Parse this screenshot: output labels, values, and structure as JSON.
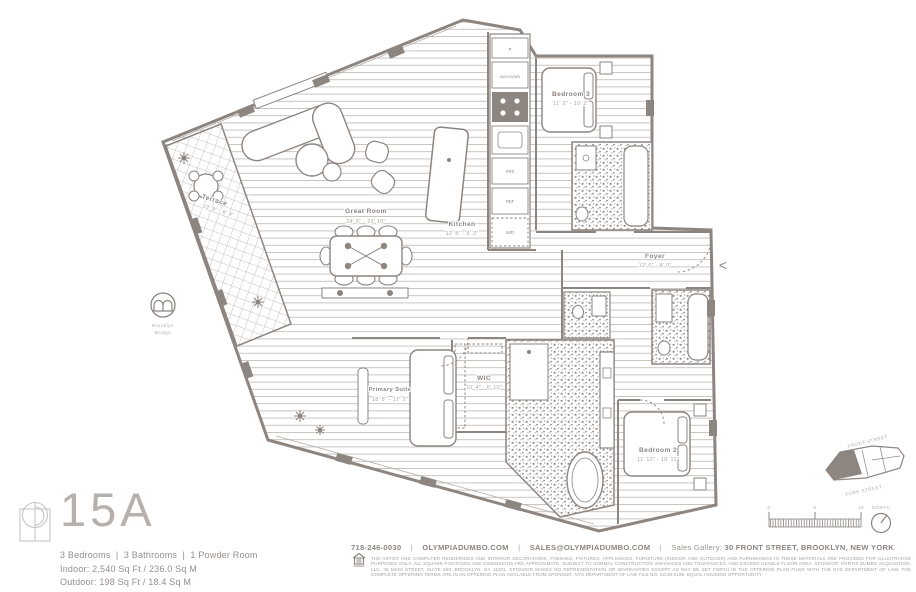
{
  "sheet": {
    "background": "#ffffff",
    "ink": "#8d8580",
    "light_ink": "#aba59f"
  },
  "unit": {
    "name": "15A",
    "config": "3 Bedrooms  |  3 Bathrooms  |  1 Powder Room",
    "indoor": "Indoor: 2,540 Sq Ft / 236.0 Sq M",
    "outdoor": "Outdoor: 198 Sq Ft / 18.4 Sq M"
  },
  "plan": {
    "rooms": [
      {
        "name": "Great Room",
        "dims": "24' 6\" - 23' 10\""
      },
      {
        "name": "Kitchen",
        "dims": "12' 8\" - 9' 3\""
      },
      {
        "name": "Foyer",
        "dims": "12' 0\" - 8' 0\""
      },
      {
        "name": "Bedroom 3",
        "dims": "11' 2\" - 10' 2\""
      },
      {
        "name": "Bedroom 2",
        "dims": "11' 10\" - 10' 11\""
      },
      {
        "name": "Primary Suite",
        "dims": "18' 5\" - 17' 2\""
      },
      {
        "name": "WIC",
        "dims": "10' 4\" - 6' 10\""
      },
      {
        "name": "Terrace",
        "dims": "23' 9\" - 8' 4\""
      }
    ],
    "appliances": {
      "pantry": "P",
      "wall_ovens": "SMO/OV/WD",
      "freezer": "FRZ",
      "refrigerator": "REF",
      "washer_dryer": "W/D"
    },
    "landmark": {
      "line1": "Brooklyn",
      "line2": "Bridge"
    },
    "entry_marker": "<",
    "scale_bar": {
      "tick0": "0",
      "tick5": "5",
      "tick10": "10"
    },
    "compass": {
      "label": "NORTH"
    },
    "key_plan": {
      "street_top": "FRONT STREET",
      "street_bottom": "YORK STREET"
    }
  },
  "footer": {
    "separator": "|",
    "phone": "718-246-0030",
    "website": "OLYMPIADUMBO.COM",
    "email": "SALES@OLYMPIADUMBO.COM",
    "gallery_label": "Sales Gallery:",
    "gallery_address": "30 FRONT STREET, BROOKLYN, NEW YORK",
    "legal_line1": "THE ARTIST AND COMPUTER RENDERINGS AND INTERIOR DECORATIONS, FINISHES, FIXTURES, APPLIANCES, FURNITURE (INDOOR AND OUTDOOR) AND FURNISHINGS IN THESE MATERIALS ARE PROVIDED FOR ILLUSTRATIVE PURPOSES ONLY. ALL SQUARE FOOTAGES AND",
    "legal_line2": "DIMENSIONS ARE APPROXIMATE, SUBJECT TO NORMAL CONSTRUCTION VARIANCES AND TOLERANCES, AND EXCEED USABLE FLOOR AREA. SPONSOR: FORTIS DUMBO ACQUISITION, LLC, 45 MAIN STREET, SUITE 800, BROOKLYN, NY 11201. SPONSOR MAKES NO REPRESENTATION OR",
    "legal_line3": "WARRANTIES EXCEPT AS MAY BE SET FORTH IN THE OFFERING PLAN FILED WITH THE NYS DEPARTMENT OF LAW. THE COMPLETE OFFERING TERMS ARE IN AN OFFERING PLAN AVAILABLE FROM SPONSOR. NYS DEPARTMENT OF LAW FILE NO. CD18-0196. EQUAL HOUSING OPPORTUNITY."
  }
}
